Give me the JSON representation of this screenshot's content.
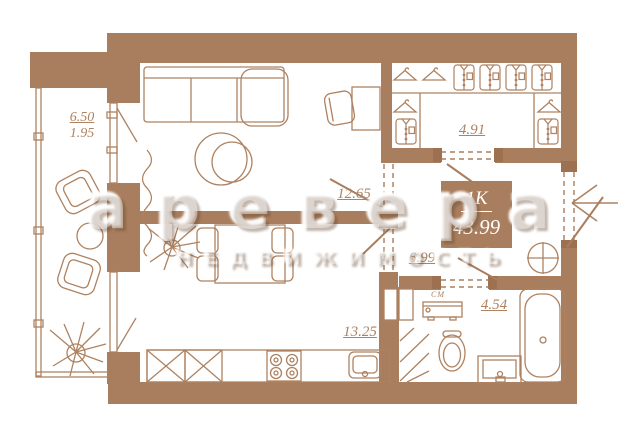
{
  "plan": {
    "watermark": {
      "brand": "аревера",
      "tagline": "НЕДВИЖИМОСТЬ"
    },
    "unit_card": {
      "type": "1К",
      "area": "43.99"
    },
    "rooms": {
      "balcony": {
        "area": "6.50",
        "area_reduced": "1.95"
      },
      "living": {
        "area": "12.65"
      },
      "wardrobe": {
        "area": "4.91"
      },
      "hallway": {
        "area": "6.99"
      },
      "bathroom": {
        "area": "4.54",
        "washer": "СМ"
      },
      "kitchen": {
        "area": "13.25"
      }
    },
    "colors": {
      "wall": "#a87e5e",
      "line": "#ae8260",
      "background": "#ffffff"
    }
  }
}
